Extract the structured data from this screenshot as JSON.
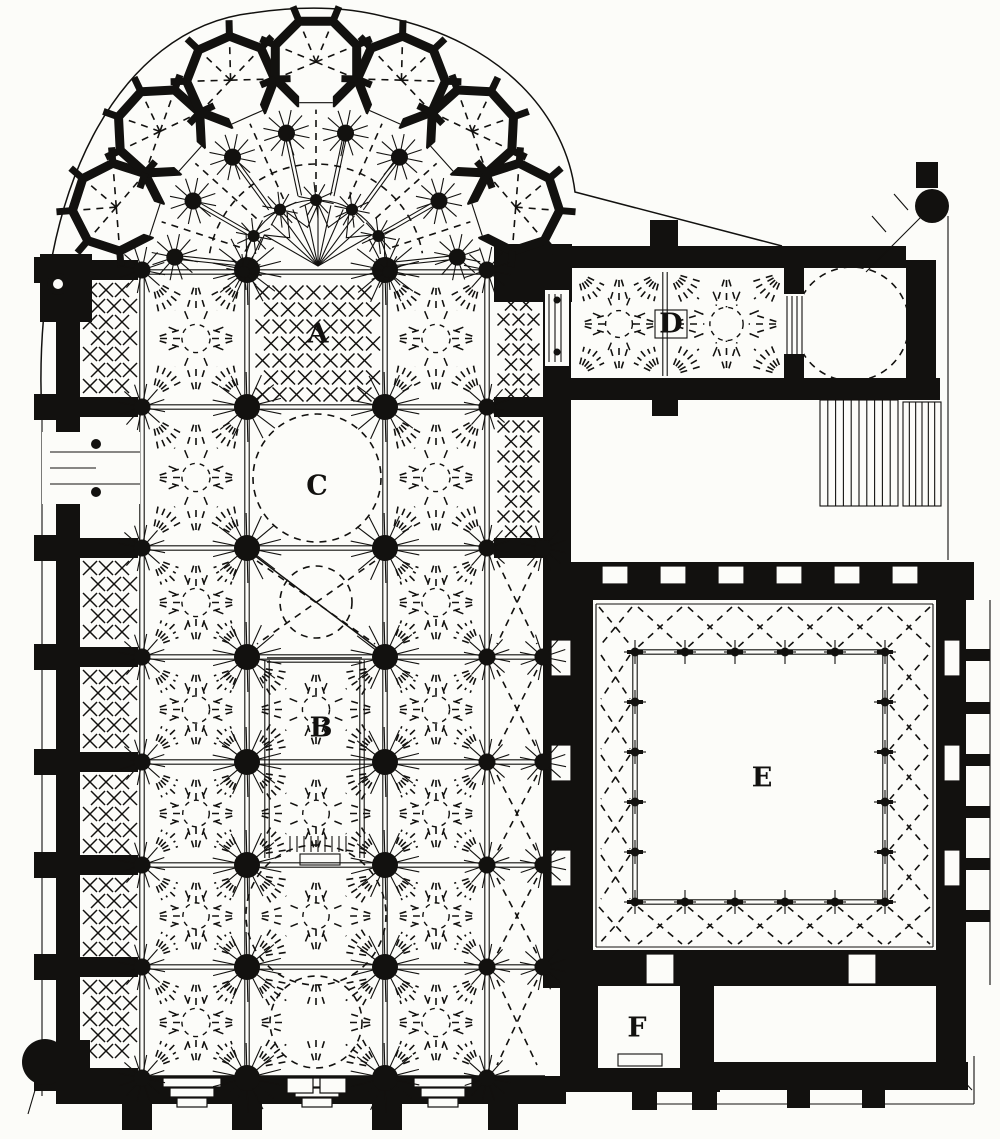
{
  "figure": {
    "kind": "engraved-cathedral-ground-plan",
    "ink_color": "#12110f",
    "paper_color": "#fcfcf9",
    "labels": [
      {
        "id": "A",
        "text": "A",
        "x": 318,
        "y": 335,
        "boxed": false
      },
      {
        "id": "B",
        "text": "B",
        "x": 321,
        "y": 729,
        "boxed": false
      },
      {
        "id": "C",
        "text": "C",
        "x": 317,
        "y": 487,
        "boxed": false
      },
      {
        "id": "D",
        "text": "D",
        "x": 671,
        "y": 325,
        "boxed": true
      },
      {
        "id": "E",
        "text": "E",
        "x": 762,
        "y": 779,
        "boxed": false
      },
      {
        "id": "F",
        "text": "F",
        "x": 637,
        "y": 1029,
        "boxed": false
      }
    ]
  }
}
